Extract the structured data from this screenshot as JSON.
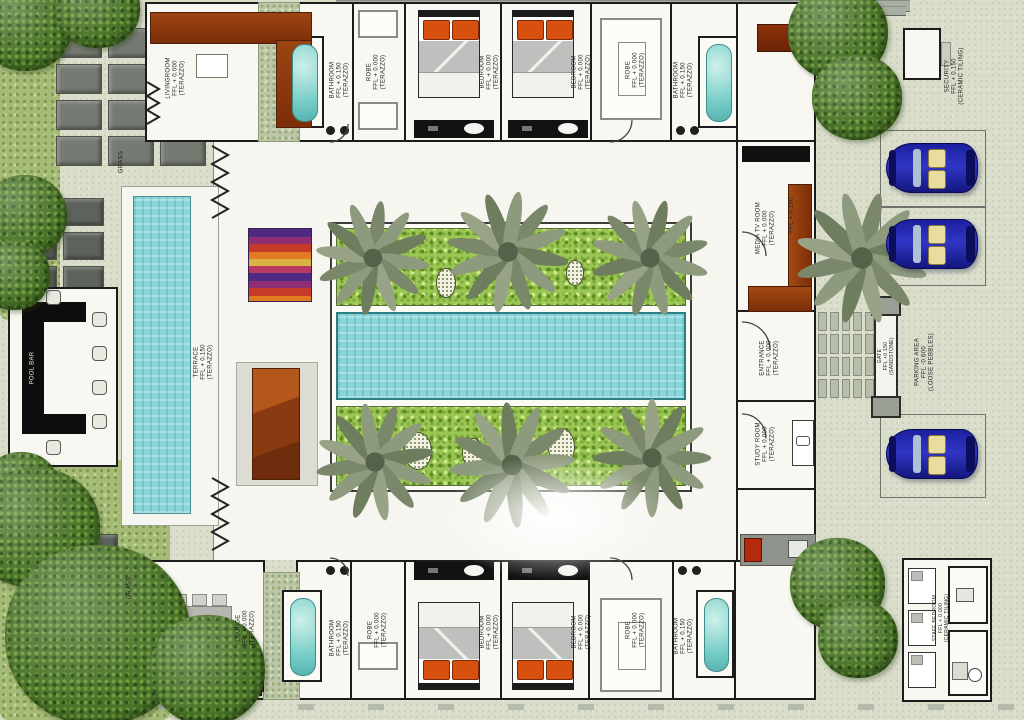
{
  "title": "Tropical villa floor plan with central courtyard pool",
  "rooms": {
    "livingroom": {
      "name": "LIVINGROOM",
      "level": "FFL + 0.000",
      "finish": "(TERAZZO)"
    },
    "bathroom_top_left": {
      "name": "BATHROOM",
      "level": "FFL + 0.150",
      "finish": "(TERAZZO)"
    },
    "robe_top_left": {
      "name": "ROBE",
      "level": "FFL + 0.000",
      "finish": "(TERAZZO)"
    },
    "bedroom_top_1": {
      "name": "BEDROOM",
      "level": "FFL + 0.000",
      "finish": "(TERAZZO)"
    },
    "bedroom_top_2": {
      "name": "BEDROOM",
      "level": "FFL + 0.000",
      "finish": "(TERAZZO)"
    },
    "robe_top_right": {
      "name": "ROBE",
      "level": "FFL + 0.000",
      "finish": "(TERAZZO)"
    },
    "bathroom_top_right": {
      "name": "BATHROOM",
      "level": "FFL + 0.150",
      "finish": "(TERAZZO)"
    },
    "media_room": {
      "name": "MEDIA TV ROOM",
      "level": "FFL + 0.000",
      "finish": "(TERAZZO)"
    },
    "entrance": {
      "name": "ENTRANCE",
      "level": "FFL + 0.000",
      "finish": "(TERAZZO)"
    },
    "study_room": {
      "name": "STUDY ROOM",
      "level": "FFL + 0.000",
      "finish": "(TERAZZO)"
    },
    "lounge": {
      "name": "LOUNGE",
      "level": "FFL + 0.000",
      "finish": "(TERAZZO)"
    },
    "bathroom_bottom_left": {
      "name": "BATHROOM",
      "level": "FFL + 0.150",
      "finish": "(TERAZZO)"
    },
    "robe_bottom_left": {
      "name": "ROBE",
      "level": "FFL + 0.000",
      "finish": "(TERAZZO)"
    },
    "bedroom_bottom_1": {
      "name": "BEDROOM",
      "level": "FFL + 0.000",
      "finish": "(TERAZZO)"
    },
    "bedroom_bottom_2": {
      "name": "BEDROOM",
      "level": "FFL + 0.000",
      "finish": "(TERAZZO)"
    },
    "robe_bottom_right": {
      "name": "ROBE",
      "level": "FFL + 0.000",
      "finish": "(TERAZZO)"
    },
    "bathroom_bottom_right": {
      "name": "BATHROOM",
      "level": "FFL + 0.150",
      "finish": "(TERAZZO)"
    },
    "terrace": {
      "name": "TERRACE",
      "level": "FFL + 0.150",
      "finish": "(TERAZZO)"
    },
    "pool_bar": {
      "name": "POOL BAR"
    },
    "security": {
      "name": "SECURITY",
      "level": "FFL + 0.150",
      "finish": "(CERAMIC TILING)"
    },
    "parking": {
      "name": "PARKING AREA",
      "level": "FFL -0.600",
      "finish": "(LOOSE PEBBLES)"
    },
    "gate": {
      "name": "GATE",
      "level": "FFL +0.150",
      "finish": "(SANDSTONE)"
    },
    "staff_bedroom": {
      "name": "STAFF BEDROOM",
      "level": "FFL + 0.000",
      "finish": "(CERAMIC TILING)"
    },
    "grass_north": {
      "name": "GRASS"
    },
    "grass_south": {
      "name": "GRASS"
    },
    "driveway": {
      "level": "FFL + 0.150"
    }
  },
  "colors": {
    "background": "#d9ddca",
    "villa_floor": "#f8f7f2",
    "walls": "#1b1b1b",
    "pool_water": "#8bd6da",
    "garden_green": "#9cc653",
    "bush_green": "#4c7429",
    "sofa_brown": "#8d3c10",
    "pillow_orange": "#d8500f",
    "car_blue": "#2023a8",
    "paver_grey": "#757a72"
  }
}
